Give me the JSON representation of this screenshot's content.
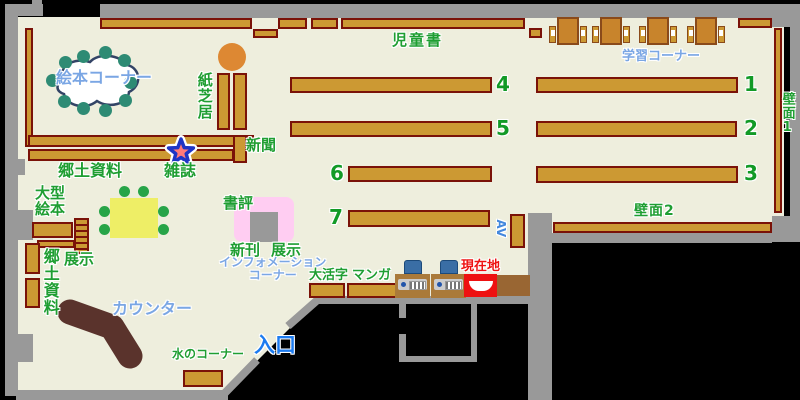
{
  "map_type": "library-floor-map",
  "labels": {
    "picture_book_corner": "絵本コーナー",
    "kamishibai": "紙芝居",
    "newspaper": "新聞",
    "magazine": "雑誌",
    "local_materials_top": "郷土資料",
    "large_picture_books_l1": "大型",
    "large_picture_books_l2": "絵本",
    "display_left": "展示",
    "local_materials_left": "郷土資料",
    "children_books": "児童書",
    "study_corner": "学習コーナー",
    "wall_1": "壁面1",
    "wall_2": "壁面2",
    "book_review": "書評",
    "new_arrivals": "新刊",
    "display_center": "展示",
    "information_l1": "インフォメーション",
    "information_l2": "コーナー",
    "large_print": "大活字",
    "manga": "マンガ",
    "av": "AV",
    "current_location": "現在地",
    "counter": "カウンター",
    "water_corner": "水のコーナー",
    "entrance": "入口"
  },
  "shelf_numbers": {
    "s1": "1",
    "s2": "2",
    "s3": "3",
    "s4": "4",
    "s5": "5",
    "s6": "6",
    "s7": "7"
  },
  "icons": {
    "magazine_marker": "star-icon",
    "current_location_marker": "red-box-marker",
    "opac_terminal": "computer-terminal-icon"
  },
  "colors": {
    "outside": "#000000",
    "floor": "#eeeedd",
    "wall_gray": "#999999",
    "shelf_fill": "#cc9933",
    "shelf_border": "#7a1208",
    "desk_fill": "#c8842c",
    "label_green": "#1f9e32",
    "label_blue": "#7aa6e4",
    "entrance_blue": "#1c7bf0",
    "current_location_red": "#ee1111",
    "counter_brown": "#5a332c",
    "table_yellow": "#eeee66",
    "chair_teal": "#2e8b74",
    "display_pink": "#ffcdf2",
    "round_table_orange": "#dd8833",
    "monitor_blue": "#3a6ea5"
  }
}
